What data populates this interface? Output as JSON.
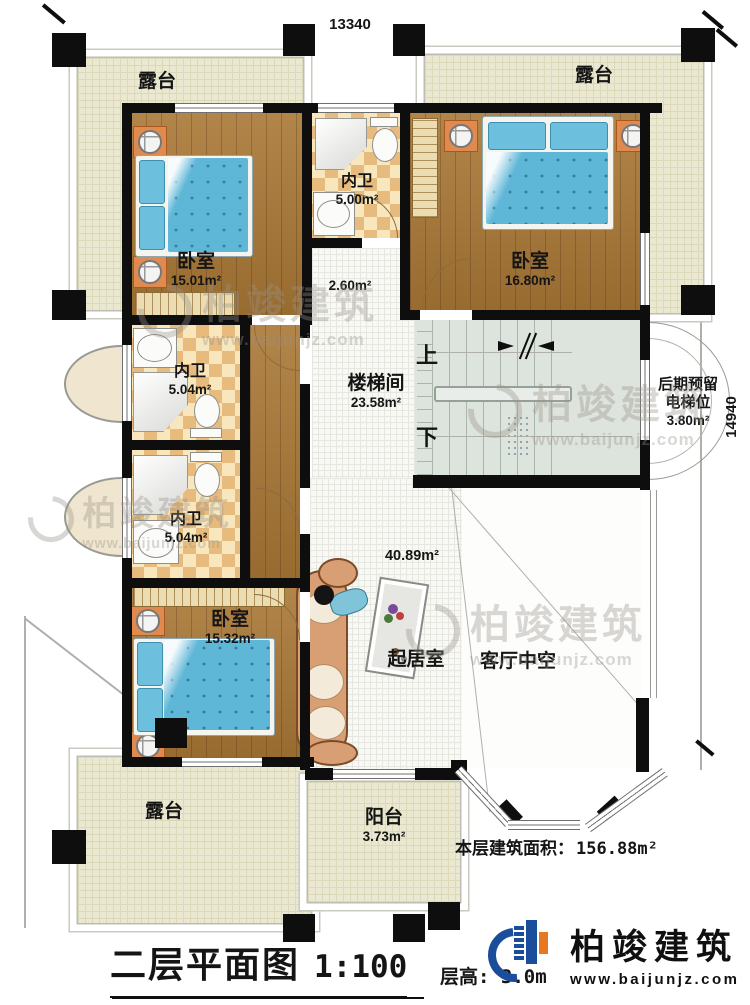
{
  "title_block": {
    "title": "二层平面图",
    "scale": "1:100",
    "floor_height": "层高: 3.0m"
  },
  "area_note": {
    "label": "本层建筑面积：",
    "value": "156.88m²"
  },
  "dimensions": {
    "top": "13340",
    "right": "14940"
  },
  "rooms": {
    "terrace_top_left": {
      "name": "露台"
    },
    "terrace_top_right": {
      "name": "露台"
    },
    "terrace_bottom_left": {
      "name": "露台"
    },
    "balcony": {
      "name": "阳台",
      "area": "3.73m²"
    },
    "bedroom_top_left": {
      "name": "卧室",
      "area": "15.01m²"
    },
    "bath_top": {
      "name": "内卫",
      "area": "5.00m²"
    },
    "bedroom_top_right": {
      "name": "卧室",
      "area": "16.80m²"
    },
    "corridor": {
      "area": "2.60m²"
    },
    "bath_middle": {
      "name": "内卫",
      "area": "5.04m²"
    },
    "bath_lower": {
      "name": "内卫",
      "area": "5.04m²"
    },
    "stairwell": {
      "name": "楼梯间",
      "area": "23.58m²",
      "up_label": "上",
      "down_label": "下"
    },
    "elevator": {
      "name_line1": "后期预留",
      "name_line2": "电梯位",
      "area": "3.80m²"
    },
    "bedroom_bottom_left": {
      "name": "卧室",
      "area": "15.32m²"
    },
    "living_room": {
      "name": "起居室",
      "area": "40.89m²"
    },
    "living_void": {
      "name": "客厅中空"
    }
  },
  "branding": {
    "company": "柏竣建筑",
    "website": "www.baijunjz.com"
  },
  "watermark": {
    "company": "柏竣建筑",
    "website": "www.baijunjz.com"
  },
  "colors": {
    "wall": "#0e0e0e",
    "wood": "#a97735",
    "terrace": "#ebe8d2",
    "checker": "#e7ba7d",
    "bed": "#5fb7d8",
    "accent_blue": "#1a4e9b",
    "accent_orange": "#e87722"
  }
}
